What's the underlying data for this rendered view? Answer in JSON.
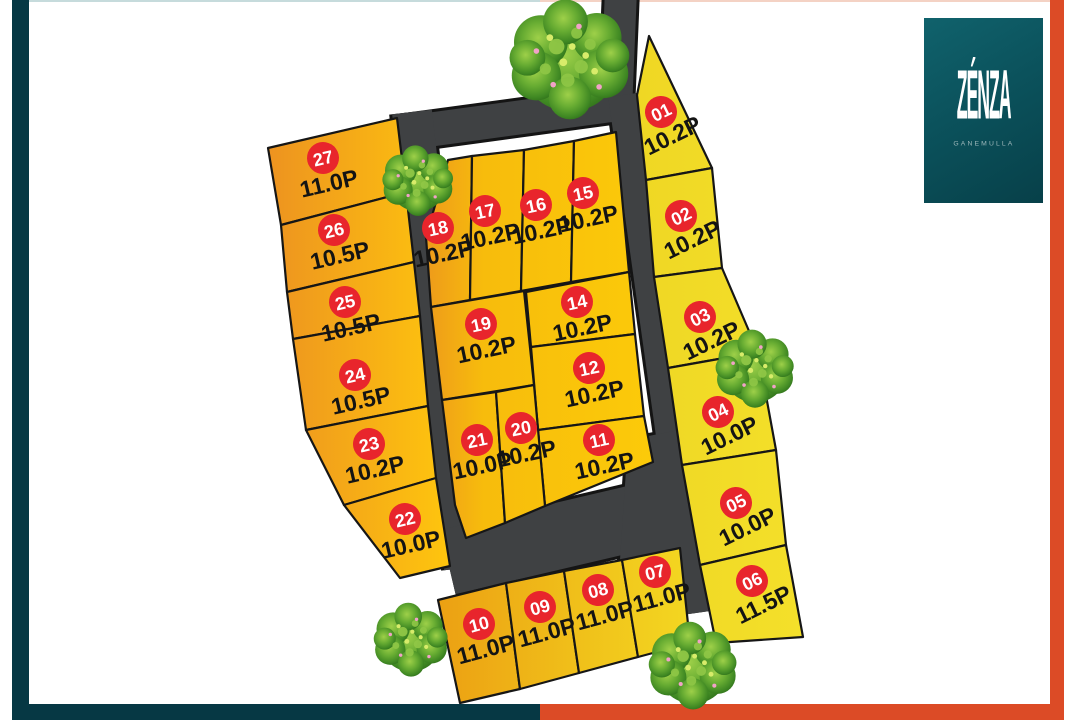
{
  "brand": {
    "name": "ZÉNZA",
    "location": "GANEMULLA"
  },
  "map": {
    "plots": {
      "p01": {
        "num": "01",
        "size": "10.2P"
      },
      "p02": {
        "num": "02",
        "size": "10.2P"
      },
      "p03": {
        "num": "03",
        "size": "10.2P"
      },
      "p04": {
        "num": "04",
        "size": "10.0P"
      },
      "p05": {
        "num": "05",
        "size": "10.0P"
      },
      "p06": {
        "num": "06",
        "size": "11.5P"
      },
      "p07": {
        "num": "07",
        "size": "11.0P"
      },
      "p08": {
        "num": "08",
        "size": "11.0P"
      },
      "p09": {
        "num": "09",
        "size": "11.0P"
      },
      "p10": {
        "num": "10",
        "size": "11.0P"
      },
      "p11": {
        "num": "11",
        "size": "10.2P"
      },
      "p12": {
        "num": "12",
        "size": "10.2P"
      },
      "p14": {
        "num": "14",
        "size": "10.2P"
      },
      "p15": {
        "num": "15",
        "size": "10.2P"
      },
      "p16": {
        "num": "16",
        "size": "10.2P"
      },
      "p17": {
        "num": "17",
        "size": "10.2P"
      },
      "p18": {
        "num": "18",
        "size": "10.2P"
      },
      "p19": {
        "num": "19",
        "size": "10.2P"
      },
      "p20": {
        "num": "20",
        "size": "10.2P"
      },
      "p21": {
        "num": "21",
        "size": "10.0P"
      },
      "p22": {
        "num": "22",
        "size": "10.0P"
      },
      "p23": {
        "num": "23",
        "size": "10.2P"
      },
      "p24": {
        "num": "24",
        "size": "10.5P"
      },
      "p25": {
        "num": "25",
        "size": "10.5P"
      },
      "p26": {
        "num": "26",
        "size": "10.5P"
      },
      "p27": {
        "num": "27",
        "size": "11.0P"
      }
    },
    "unit": "P (perches)"
  },
  "colors": {
    "badge_red": "#E8252C",
    "road_gray": "#3F4143",
    "frame_teal": "#063844",
    "frame_orange": "#DC4B26",
    "plot_orange": "#ED9320",
    "plot_gold": "#FACA0B",
    "plot_yellow": "#F2DC22",
    "tree_green": "#53982B",
    "logo_teal": "#0E5860"
  }
}
